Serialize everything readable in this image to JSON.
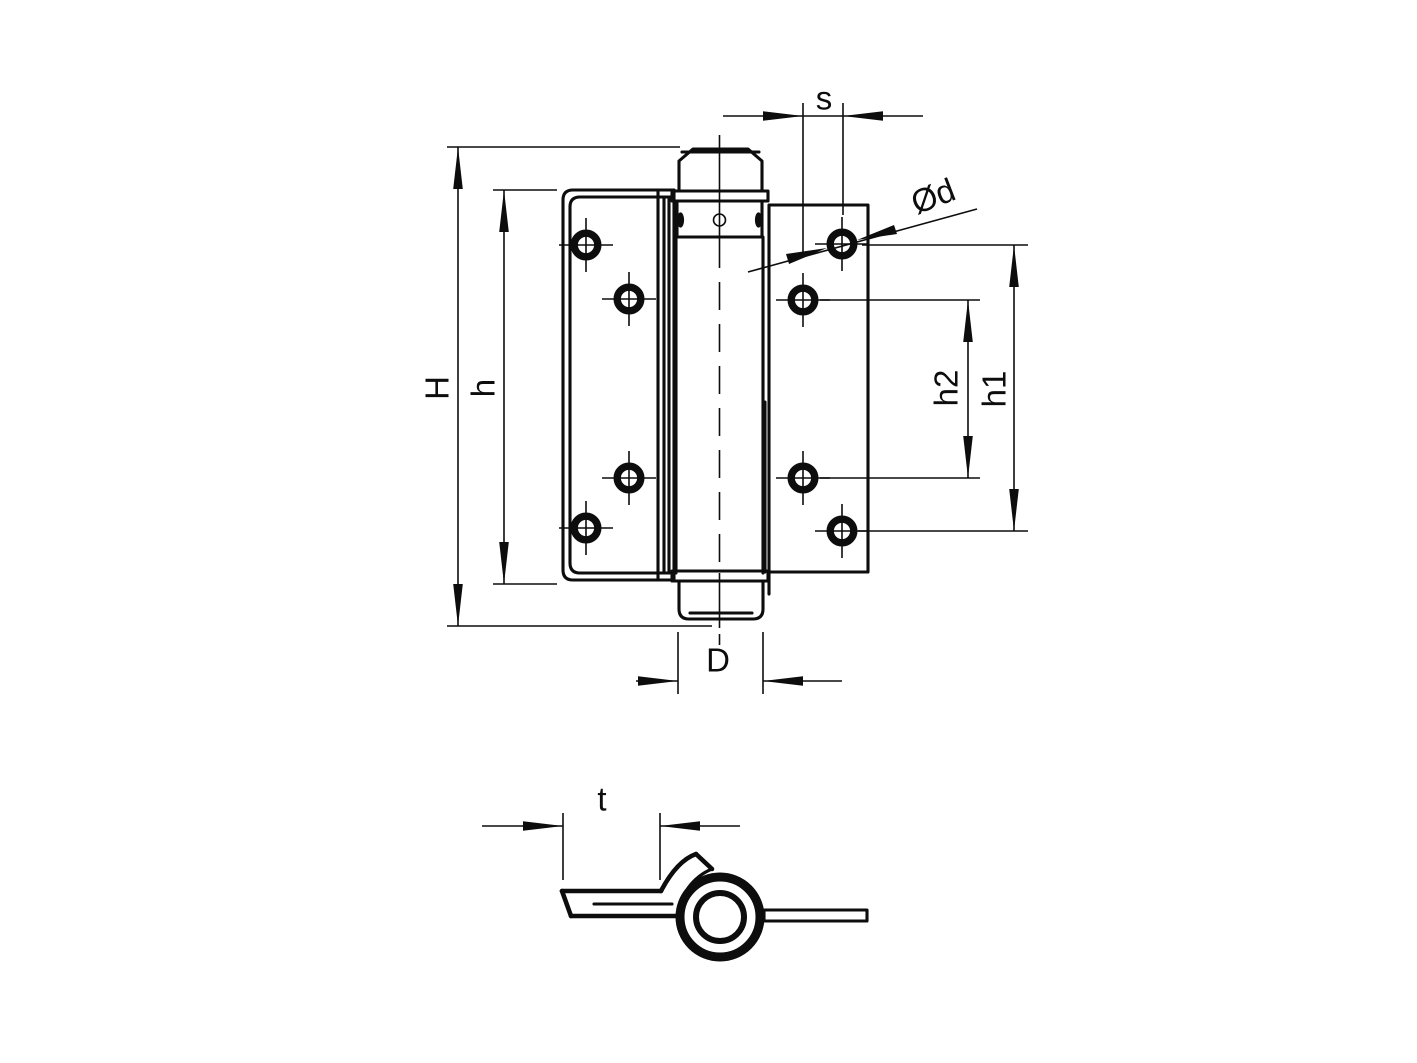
{
  "colors": {
    "background": "#ffffff",
    "line": "#0d0d0d"
  },
  "dim_labels": {
    "H": "H",
    "h": "h",
    "h1": "h1",
    "h2": "h2",
    "s": "s",
    "d": "Ød",
    "D": "D",
    "t": "t"
  }
}
